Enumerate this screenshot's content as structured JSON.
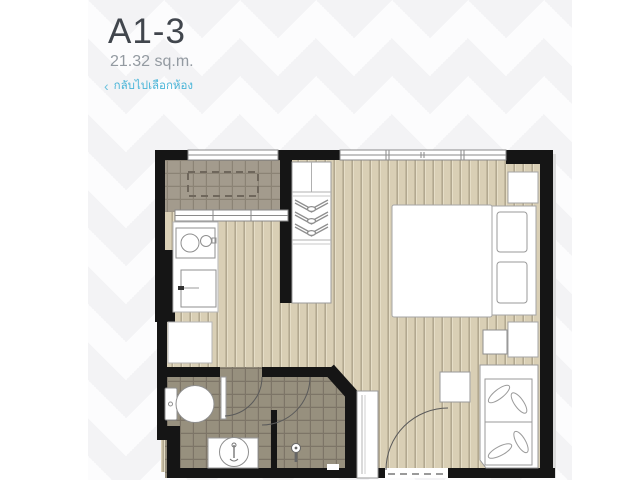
{
  "header": {
    "unit_title": "A1-3",
    "unit_area": "21.32 sq.m.",
    "back_link": {
      "chevron": "‹",
      "label": "กลับไปเลือกห้อง"
    }
  },
  "colors": {
    "link_accent": "#4ab5d8",
    "title_text": "#41464d",
    "subtitle_text": "#939aa1",
    "wall": "#151515",
    "wood_floor": "#d9cfb5",
    "wood_plank_line": "#b2a890",
    "wood_plank_highlight": "#e7dfc9",
    "bath_tile": "#97907e",
    "bath_tile_line": "#7d7567",
    "balcony_tile": "#a39b8d",
    "balcony_tile_line": "#8b8375",
    "furniture_fill": "#ffffff",
    "furniture_line": "#999999",
    "background_chevron": "#f3f3f5"
  },
  "floorplan": {
    "rooms": [
      "balcony",
      "kitchen",
      "wardrobe-nook",
      "sleeping-area",
      "living-area",
      "bathroom",
      "entrance"
    ],
    "fixtures": [
      "ac-condenser",
      "cooktop-sink",
      "refrigerator",
      "washing-machine",
      "clothes-hangers",
      "double-bed",
      "pillows",
      "nightstands",
      "side-stool",
      "coffee-table",
      "daybed-sofa",
      "toilet",
      "washbasin",
      "shower",
      "shoe-cabinet",
      "entrance-door",
      "bathroom-door",
      "shower-door",
      "windows"
    ]
  }
}
